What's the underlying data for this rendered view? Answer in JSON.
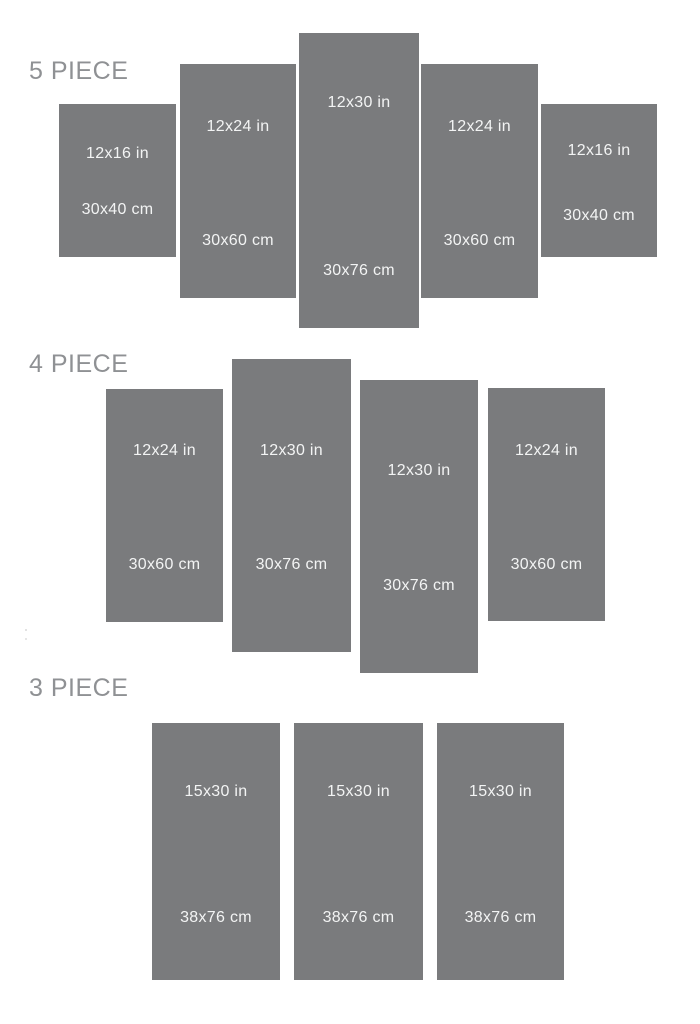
{
  "theme": {
    "background": "#ffffff",
    "panel_color": "#7a7b7d",
    "panel_text_color": "#f3f4f4",
    "section_label_color": "#8f9194"
  },
  "sections": [
    {
      "label": "5 PIECE",
      "panels": [
        {
          "inches": "12x16 in",
          "cm": "30x40 cm"
        },
        {
          "inches": "12x24 in",
          "cm": "30x60 cm"
        },
        {
          "inches": "12x30 in",
          "cm": "30x76 cm"
        },
        {
          "inches": "12x24 in",
          "cm": "30x60 cm"
        },
        {
          "inches": "12x16 in",
          "cm": "30x40 cm"
        }
      ]
    },
    {
      "label": "4 PIECE",
      "panels": [
        {
          "inches": "12x24 in",
          "cm": "30x60 cm"
        },
        {
          "inches": "12x30 in",
          "cm": "30x76 cm"
        },
        {
          "inches": "12x30 in",
          "cm": "30x76 cm"
        },
        {
          "inches": "12x24 in",
          "cm": "30x60 cm"
        }
      ]
    },
    {
      "label": "3 PIECE",
      "panels": [
        {
          "inches": "15x30 in",
          "cm": "38x76 cm"
        },
        {
          "inches": "15x30 in",
          "cm": "38x76 cm"
        },
        {
          "inches": "15x30 in",
          "cm": "38x76 cm"
        }
      ]
    }
  ]
}
